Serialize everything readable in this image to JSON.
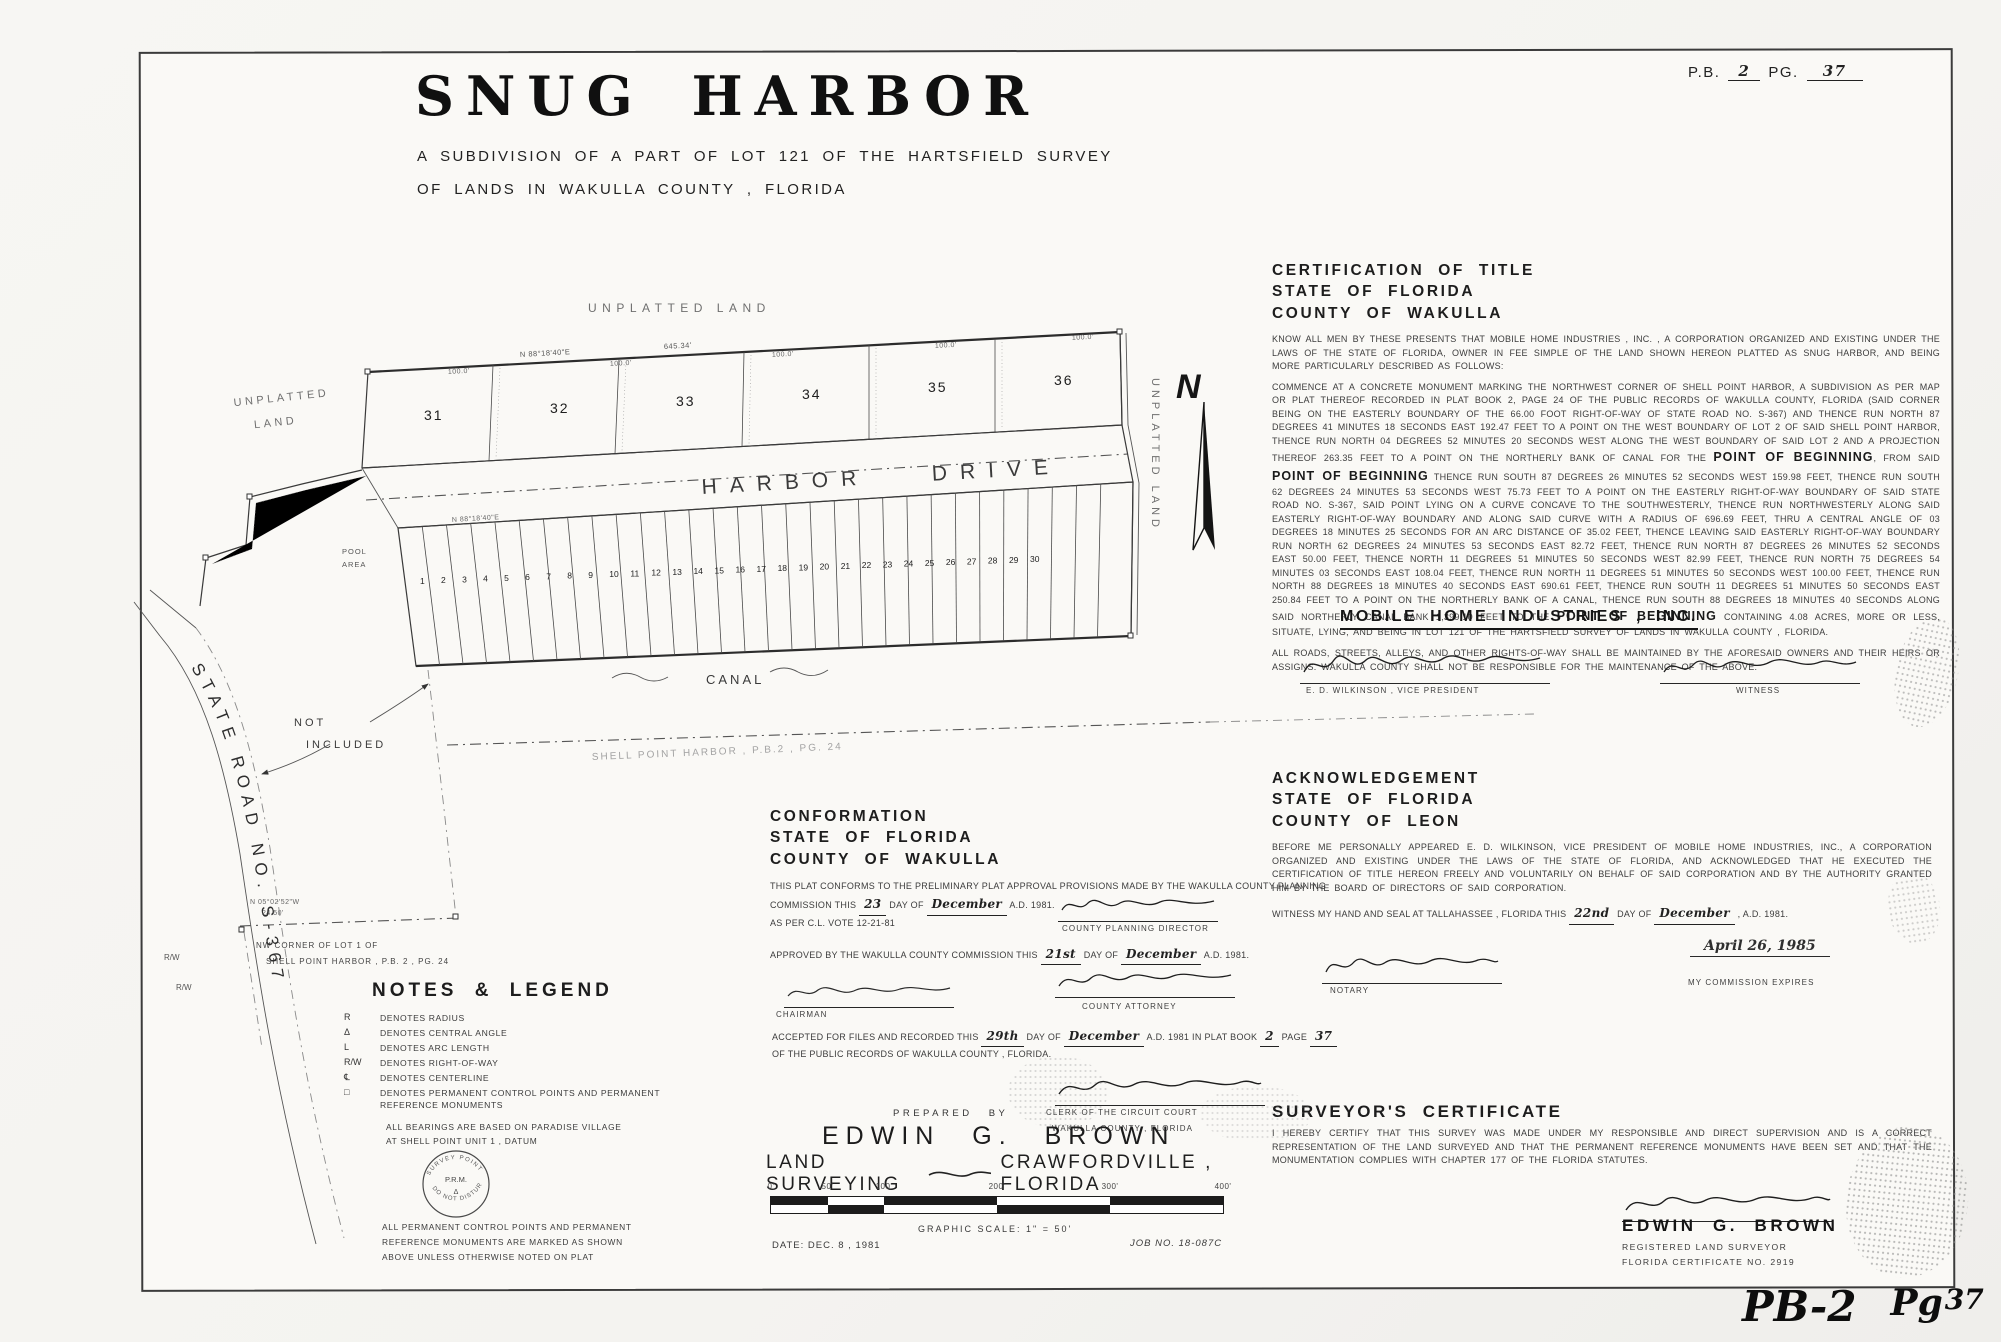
{
  "page": {
    "pb_label": "P.B.",
    "pb_value": "2",
    "pg_label": "PG.",
    "pg_value": "37",
    "stamp_left": "PB-2",
    "stamp_mid": "Pg",
    "stamp_num": "37"
  },
  "title": {
    "word1": "SNUG",
    "word2": "HARBOR",
    "subtitle_line1": "A SUBDIVISION OF A PART OF LOT 121 OF THE HARTSFIELD SURVEY",
    "subtitle_line2": "OF LANDS IN WAKULLA COUNTY , FLORIDA"
  },
  "map": {
    "unplatted_top": "UNPLATTED LAND",
    "unplatted_left_line1": "UNPLATTED",
    "unplatted_left_line2": "LAND",
    "unplatted_right": "UNPLATTED LAND",
    "north_letter": "N",
    "harbor_drive": "HARBOR DRIVE",
    "canal": "CANAL",
    "pool_line1": "POOL",
    "pool_line2": "AREA",
    "not_included_line1": "NOT",
    "not_included_line2": "INCLUDED",
    "state_road": "STATE ROAD NO. S-367",
    "shell_point_faint": "SHELL POINT HARBOR , P.B.2 , PG. 24",
    "nw_corner_line1": "NW CORNER OF LOT 1 OF",
    "nw_corner_line2": "SHELL POINT HARBOR , P.B. 2 , PG. 24",
    "bearing_top": "N 88°18'40\"E",
    "dist_top": "645.34'",
    "dim_100": "100.0'",
    "bearing_road": "N 88°18'40\"E",
    "jog_bearing": "N 05°02'52\"W",
    "jog_dist": "24.50'",
    "rw": "R/W",
    "top_lots": [
      "31",
      "32",
      "33",
      "34",
      "35",
      "36"
    ],
    "small_lot_numbers": [
      "1",
      "2",
      "3",
      "4",
      "5",
      "6",
      "7",
      "8",
      "9",
      "10",
      "11",
      "12",
      "13",
      "14",
      "15",
      "16",
      "17",
      "18",
      "19",
      "20",
      "21",
      "22",
      "23",
      "24",
      "25",
      "26",
      "27",
      "28",
      "29",
      "30"
    ]
  },
  "certification": {
    "heading_lines": [
      "CERTIFICATION OF TITLE",
      "STATE OF FLORIDA",
      "COUNTY OF WAKULLA"
    ],
    "intro": "KNOW ALL MEN BY THESE PRESENTS THAT MOBILE HOME INDUSTRIES , INC. , A CORPORATION ORGANIZED AND EXISTING UNDER THE LAWS OF THE STATE OF FLORIDA, OWNER IN FEE SIMPLE OF THE LAND SHOWN HEREON PLATTED AS SNUG HARBOR, AND BEING MORE PARTICULARLY DESCRIBED AS FOLLOWS:",
    "description_parts": [
      {
        "text": "COMMENCE AT A CONCRETE MONUMENT MARKING THE NORTHWEST CORNER OF SHELL POINT HARBOR, A SUBDIVISION AS PER MAP OR PLAT THEREOF RECORDED IN PLAT BOOK 2, PAGE 24 OF THE PUBLIC RECORDS OF WAKULLA COUNTY, FLORIDA (SAID CORNER BEING ON THE EASTERLY BOUNDARY OF THE 66.00 FOOT RIGHT-OF-WAY OF STATE ROAD NO. S-367) AND THENCE RUN NORTH 87 DEGREES 41 MINUTES 18 SECONDS EAST 192.47 FEET TO A POINT ON THE WEST BOUNDARY OF LOT 2 OF SAID SHELL POINT HARBOR, THENCE RUN NORTH 04 DEGREES 52 MINUTES 20 SECONDS WEST ALONG THE WEST BOUNDARY OF SAID LOT 2 AND A PROJECTION THEREOF 263.35 FEET TO A POINT ON THE NORTHERLY BANK OF CANAL FOR THE ",
        "bold": false
      },
      {
        "text": "POINT OF BEGINNING",
        "bold": true
      },
      {
        "text": ", FROM SAID ",
        "bold": false
      },
      {
        "text": "POINT OF BEGINNING",
        "bold": true
      },
      {
        "text": " THENCE RUN SOUTH 87 DEGREES 26 MINUTES 52 SECONDS WEST 159.98 FEET, THENCE RUN SOUTH 62 DEGREES 24 MINUTES 53 SECONDS WEST 75.73 FEET TO A POINT ON THE EASTERLY RIGHT-OF-WAY BOUNDARY OF SAID STATE ROAD NO. S-367, SAID POINT LYING ON A CURVE CONCAVE TO THE SOUTHWESTERLY, THENCE RUN NORTHWESTERLY ALONG SAID EASTERLY RIGHT-OF-WAY BOUNDARY AND ALONG SAID CURVE WITH A RADIUS OF 696.69 FEET, THRU A CENTRAL ANGLE OF 03 DEGREES 18 MINUTES 25 SECONDS FOR AN ARC DISTANCE OF 35.02 FEET, THENCE LEAVING SAID EASTERLY RIGHT-OF-WAY BOUNDARY RUN NORTH 62 DEGREES 24 MINUTES 53 SECONDS EAST 82.72 FEET, THENCE RUN NORTH 87 DEGREES 26 MINUTES 52 SECONDS EAST 50.00 FEET, THENCE NORTH 11 DEGREES 51 MINUTES 50 SECONDS WEST 82.99 FEET, THENCE RUN NORTH 75 DEGREES 54 MINUTES 03 SECONDS EAST 108.04 FEET, THENCE RUN NORTH 11 DEGREES 51 MINUTES 50 SECONDS WEST 100.00 FEET, THENCE RUN NORTH 88 DEGREES 18 MINUTES 40 SECONDS EAST 690.61 FEET, THENCE RUN SOUTH 11 DEGREES 51 MINUTES 50 SECONDS EAST 250.84 FEET TO A POINT ON THE NORTHERLY BANK OF A CANAL, THENCE RUN SOUTH 88 DEGREES 18 MINUTES 40 SECONDS ALONG SAID NORTHERLY CANAL BANK 1,399.10 FEET TO THE ",
        "bold": false
      },
      {
        "text": "POINT OF BEGINNING",
        "bold": true
      },
      {
        "text": " CONTAINING 4.08 ACRES, MORE OR LESS, SITUATE, LYING, AND BEING IN LOT 121 OF THE HARTSFIELD SURVEY OF LANDS IN WAKULLA COUNTY , FLORIDA.",
        "bold": false
      }
    ],
    "roads_note": "ALL ROADS, STREETS, ALLEYS, AND OTHER RIGHTS-OF-WAY SHALL BE MAINTAINED BY THE AFORESAID OWNERS AND THEIR HEIRS OR ASSIGNS. WAKULLA COUNTY SHALL NOT BE RESPONSIBLE FOR THE MAINTENANCE OF THE ABOVE."
  },
  "owner": {
    "name": "MOBILE HOME INDUSTRIES , INC.",
    "signer_label": "E. D. WILKINSON , VICE PRESIDENT",
    "witness_label": "WITNESS"
  },
  "acknowledgement": {
    "heading_lines": [
      "ACKNOWLEDGEMENT",
      "STATE OF FLORIDA",
      "COUNTY OF LEON"
    ],
    "body": "BEFORE ME PERSONALLY APPEARED E. D. WILKINSON, VICE PRESIDENT OF MOBILE HOME INDUSTRIES, INC., A CORPORATION ORGANIZED AND EXISTING UNDER THE LAWS OF THE STATE OF FLORIDA, AND ACKNOWLEDGED THAT HE EXECUTED THE CERTIFICATION OF TITLE HEREON FREELY AND VOLUNTARILY ON BEHALF OF SAID CORPORATION AND BY THE AUTHORITY GRANTED HIM BY THE BOARD OF DIRECTORS OF SAID CORPORATION.",
    "witness_prefix": "WITNESS MY HAND AND SEAL AT TALLAHASSEE , FLORIDA THIS",
    "witness_day": "22nd",
    "witness_mid": "DAY OF",
    "witness_month": "December",
    "witness_suffix": ", A.D. 1981.",
    "notary_label": "NOTARY",
    "commission_date": "April 26, 1985",
    "commission_label": "MY COMMISSION EXPIRES"
  },
  "conformation": {
    "heading_lines": [
      "CONFORMATION",
      "STATE OF FLORIDA",
      "COUNTY OF WAKULLA"
    ],
    "body_prefix": "THIS PLAT CONFORMS TO THE PRELIMINARY PLAT APPROVAL PROVISIONS MADE BY THE WAKULLA COUNTY PLANNING COMMISSION THIS",
    "body_day": "23",
    "body_mid": "DAY OF",
    "body_month": "December",
    "body_suffix": "A.D. 1981.",
    "vote_note": "AS PER C.L. VOTE 12-21-81",
    "planning_label": "COUNTY PLANNING DIRECTOR",
    "approved_prefix": "APPROVED BY THE WAKULLA COUNTY COMMISSION THIS",
    "approved_day": "21st",
    "approved_mid": "DAY OF",
    "approved_month": "December",
    "approved_suffix": "A.D. 1981.",
    "chairman_label": "CHAIRMAN",
    "attorney_label": "COUNTY ATTORNEY"
  },
  "recording": {
    "prefix": "ACCEPTED FOR FILES AND RECORDED THIS",
    "day": "29th",
    "mid": "DAY OF",
    "month": "December",
    "suffix": "A.D. 1981 IN",
    "line2_prefix": "PLAT BOOK",
    "book": "2",
    "line2_mid": "PAGE",
    "page": "37",
    "line2_suffix": "OF THE PUBLIC RECORDS OF WAKULLA COUNTY , FLORIDA.",
    "clerk_label_line1": "CLERK OF THE CIRCUIT COURT",
    "clerk_label_line2": "WAKULLA COUNTY , FLORIDA"
  },
  "notes_legend": {
    "heading": "NOTES & LEGEND",
    "rows": [
      {
        "symbol": "R",
        "text": "DENOTES RADIUS"
      },
      {
        "symbol": "Δ",
        "text": "DENOTES CENTRAL ANGLE"
      },
      {
        "symbol": "L",
        "text": "DENOTES ARC LENGTH"
      },
      {
        "symbol": "R/W",
        "text": "DENOTES RIGHT-OF-WAY"
      },
      {
        "symbol": "℄",
        "text": "DENOTES CENTERLINE"
      },
      {
        "symbol": "□",
        "text": "DENOTES PERMANENT CONTROL POINTS AND PERMANENT REFERENCE MONUMENTS"
      }
    ],
    "bearing_note_line1": "ALL BEARINGS ARE BASED ON PARADISE VILLAGE",
    "bearing_note_line2": "AT SHELL POINT UNIT 1 , DATUM",
    "seal_top": "SURVEY POINT",
    "seal_bottom": "DO NOT DISTURB",
    "seal_center": "P.R.M.",
    "perm_note_lines": [
      "ALL PERMANENT CONTROL POINTS AND PERMANENT",
      "REFERENCE MONUMENTS ARE MARKED AS SHOWN",
      "ABOVE UNLESS OTHERWISE NOTED ON PLAT"
    ]
  },
  "prepared": {
    "prepared_by": "PREPARED BY",
    "name": "EDWIN G. BROWN",
    "left": "LAND SURVEYING",
    "right": "CRAWFORDVILLE , FLORIDA",
    "graphic_scale": "GRAPHIC SCALE: 1\" = 50'",
    "date": "DATE: DEC. 8 , 1981",
    "job": "JOB NO. 18-087C",
    "scale_labels": [
      "0'",
      "50'",
      "100'",
      "200'",
      "300'",
      "400'"
    ]
  },
  "surveyor": {
    "heading": "SURVEYOR'S CERTIFICATE",
    "body": "I HEREBY CERTIFY THAT THIS SURVEY WAS MADE UNDER MY RESPONSIBLE AND DIRECT SUPERVISION AND IS A CORRECT REPRESENTATION OF THE LAND SURVEYED AND THAT THE PERMANENT REFERENCE MONUMENTS HAVE BEEN SET AND THAT THE MONUMENTATION COMPLIES WITH CHAPTER 177 OF THE FLORIDA STATUTES.",
    "name": "EDWIN G. BROWN",
    "title_line": "REGISTERED LAND SURVEYOR",
    "cert_line": "FLORIDA CERTIFICATE NO. 2919"
  }
}
